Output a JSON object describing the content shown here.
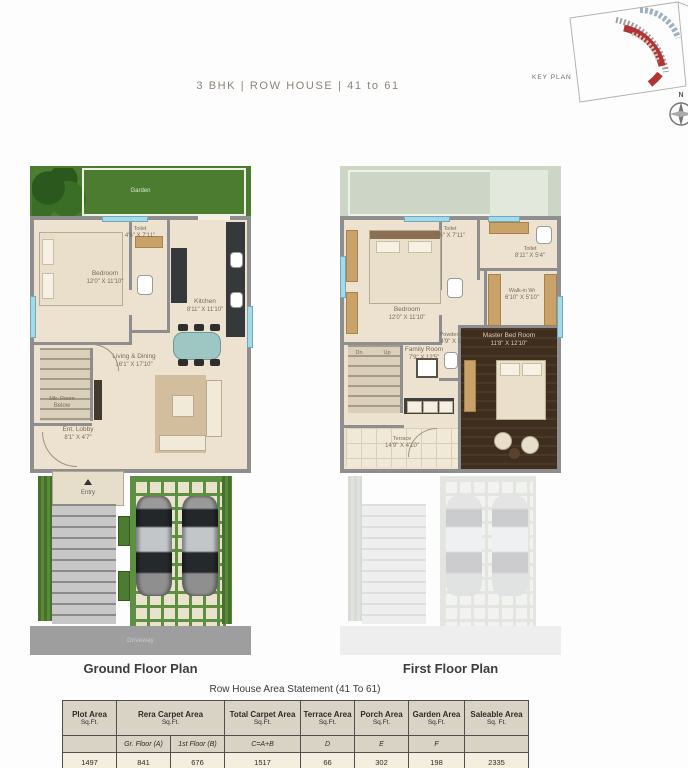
{
  "page": {
    "title": "3 BHK | ROW HOUSE | 41 to 61",
    "key_plan_label": "KEY PLAN",
    "compass_label": "N"
  },
  "colors": {
    "garden_green": "#4c7c30",
    "wall_gray": "#8e8e8e",
    "floor_cream": "#ece2cf",
    "master_wood": "#3f2d1d",
    "window_blue": "#a5d9e8",
    "keyplan_highlight_red": "#b23434",
    "table_header_bg": "#d8d3c5",
    "table_value_bg": "#f3eedd"
  },
  "ground_floor": {
    "caption": "Ground Floor Plan",
    "rooms": {
      "garden": {
        "name": "Garden"
      },
      "bedroom": {
        "name": "Bedroom",
        "size": "12'0\" X 11'10\""
      },
      "toilet": {
        "name": "Toilet",
        "size": "4'6\" X 7'11\""
      },
      "kitchen": {
        "name": "Kitchen",
        "size": "8'11\" X 11'10\""
      },
      "living": {
        "name": "Living & Dining",
        "size": "16'1\" X 17'10\""
      },
      "lobby": {
        "name": "Ent. Lobby",
        "size": "8'1\" X 4'7\""
      },
      "stair_note": {
        "name": "Mtr. Room",
        "size": "Below"
      },
      "entry": "Entry",
      "driveway": "Driveway"
    }
  },
  "first_floor": {
    "caption": "First Floor Plan",
    "rooms": {
      "bedroom": {
        "name": "Bedroom",
        "size": "12'0\" X 11'10\""
      },
      "toilet_top": {
        "name": "Toilet",
        "size": "4'6\" X 7'11\""
      },
      "toilet_right": {
        "name": "Toilet",
        "size": "8'11\" X 5'4\""
      },
      "walkin": {
        "name": "Walk-in Wr",
        "size": "6'10\" X 5'10\""
      },
      "powder": {
        "name": "Powder Rm",
        "size": "4'9\" X 5'4\""
      },
      "family": {
        "name": "Family Room",
        "size": "7'9\" X 12'5\""
      },
      "master": {
        "name": "Master Bed Room",
        "size": "11'8\" X 12'10\""
      },
      "terrace": {
        "name": "Terrace",
        "size": "14'9\" X 4'10\""
      },
      "stairs_down": "Dn",
      "stairs_up": "Up"
    }
  },
  "table": {
    "title": "Row House Area Statement (41 To 61)",
    "headers": [
      {
        "label": "Plot Area",
        "unit": "Sq.Ft."
      },
      {
        "label": "Rera Carpet Area",
        "unit": "Sq.Ft."
      },
      {
        "label": "Total Carpet Area",
        "unit": "Sq.Ft."
      },
      {
        "label": "Terrace Area",
        "unit": "Sq.Ft."
      },
      {
        "label": "Porch Area",
        "unit": "Sq.Ft."
      },
      {
        "label": "Garden Area",
        "unit": "Sq.Ft."
      },
      {
        "label": "Saleable Area",
        "unit": "Sq. Ft."
      }
    ],
    "subheaders": {
      "gr_floor": "Gr. Floor (A)",
      "first_floor": "1st Floor (B)",
      "total": "C=A+B",
      "terrace": "D",
      "porch": "E",
      "garden": "F"
    },
    "values": {
      "plot": "1497",
      "gr_floor": "841",
      "first_floor": "676",
      "total": "1517",
      "terrace": "66",
      "porch": "302",
      "garden": "198",
      "saleable": "2335"
    }
  }
}
